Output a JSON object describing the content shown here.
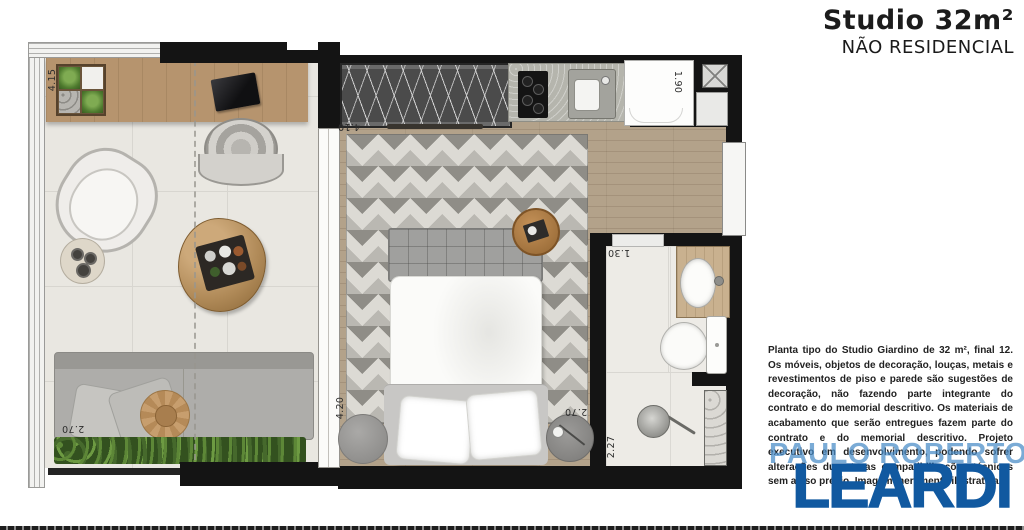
{
  "header": {
    "title": "Studio 32m²",
    "subtitle": "NÃO RESIDENCIAL"
  },
  "disclaimer": "Planta tipo do Studio Giardino de 32 m², final 12. Os móveis, objetos de decoração, louças, metais e revestimentos de piso e parede são sugestões de decoração, não fazendo parte integrante do contrato e do memorial descritivo. Os materiais de acabamento que serão entregues fazem parte do contrato e do memorial descritivo. Projeto executivo em desenvolvimento, podendo sofrer alterações durante as compatibilizações técnicas sem aviso prévio. Imagem meramente ilustrativa.",
  "watermark": {
    "agent_name": "PAULO ROBERTO",
    "brand": "LEARDI"
  },
  "colors": {
    "brand_blue": "#1159a0",
    "watermark_blue": "#468ac6",
    "wall_black": "#141414"
  },
  "floorplan": {
    "dims": {
      "terrace_width": "4.15",
      "terrace_depth": "2.70",
      "kitchen_wall": "4.10",
      "bedroom_length": "4.20",
      "bedroom_width": "2.70",
      "appliance_niche": "1.90",
      "bathroom_width": "1.30",
      "bathroom_length": "2.27"
    }
  }
}
